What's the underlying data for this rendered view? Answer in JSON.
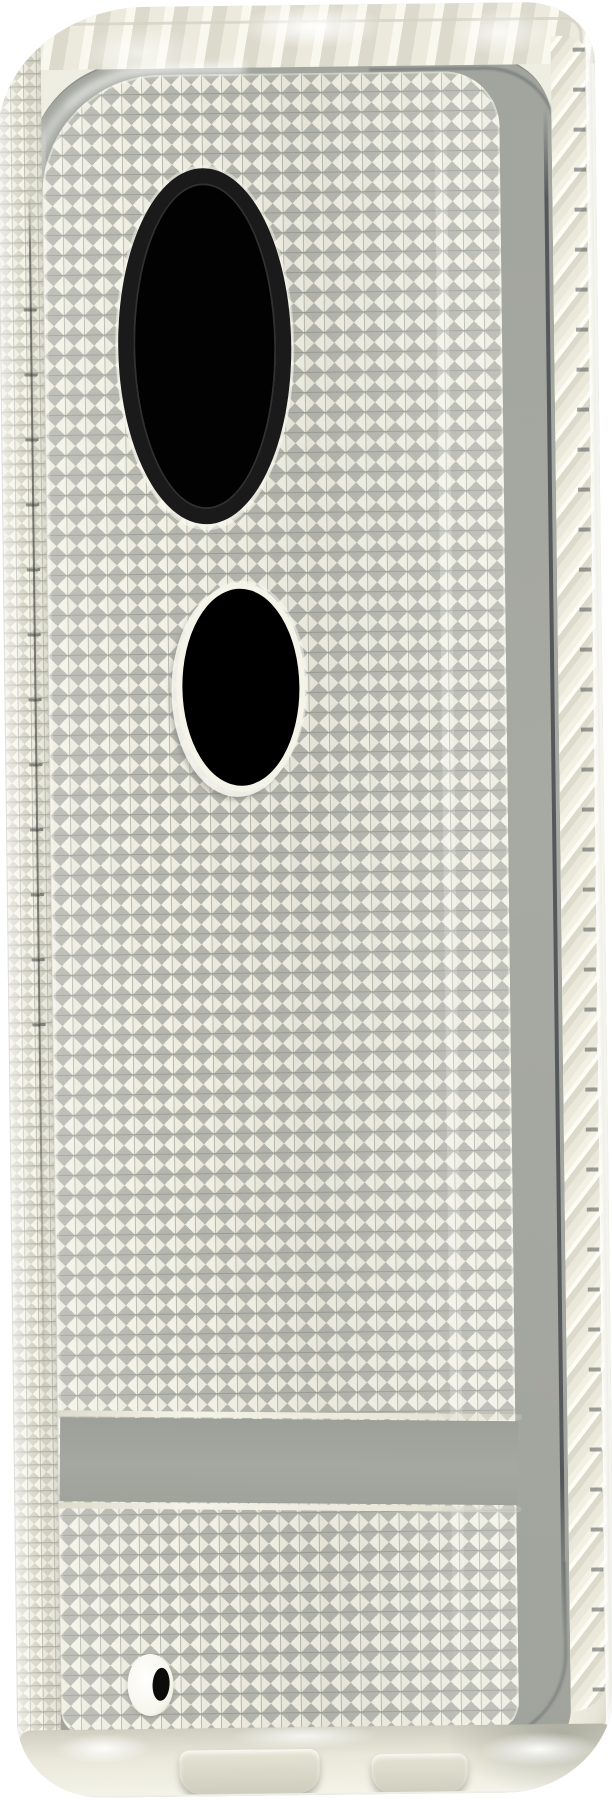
{
  "scene": {
    "type": "product-photo",
    "subject": "clear transparent phone case with diamond-stud texture",
    "view": "rear three-quarter angle",
    "visible_text": ""
  },
  "case": {
    "material": "clear flexible shell",
    "back_texture": "grid of small square diamond studs",
    "side_texture": "chevron facet rail on right edge",
    "cutouts": [
      {
        "name": "camera-cutout",
        "shape": "tall oval",
        "ring_color": "#1a1a1a",
        "hole_color": "#020202"
      },
      {
        "name": "fingerprint-cutout",
        "shape": "oval",
        "rim_color": "#f5f4e9",
        "hole_color": "#000000"
      },
      {
        "name": "mic-hole",
        "shape": "small oval",
        "ring_color": "#f7f6ec",
        "hole_color": "#0c0c0a"
      }
    ],
    "brand_band": {
      "present": true,
      "finish": "smooth untextured strip near bottom"
    },
    "bottom_edge": {
      "port_bumps": 2,
      "finish": "clear with glare highlights"
    }
  },
  "colors": {
    "background": "#ffffff",
    "case-face": "#efeee2",
    "case-edge": "#e2e1d2",
    "rim-ivory": "#eceadd",
    "phone-gray": "#a7aaa2",
    "band-gray": "#a5a8a0",
    "stud-base": "#9da098",
    "stud-light": "#f3f2e6",
    "stud-facet": "#b4b6ad",
    "phone-edge-dark": "#55585a",
    "chevron-fleck": "rgba(79,84,82,.55)",
    "camera-ring": "#1a1a1a",
    "camera-hole": "#020202",
    "fingerprint-hole": "#000000",
    "cutout-rim": "#f5f4e9",
    "mic-ring": "#f7f6ec",
    "mic-hole": "#0c0c0a"
  },
  "geometry": {
    "stage-width": "612px",
    "stage-height": "1800px",
    "camera-center": "(205, 340)",
    "camera-size": "173 x 356",
    "fingerprint-center": "(243, 687)",
    "fingerprint-size": "129 x 209",
    "band-y": "1420-1505",
    "mic-hole-center": "(140, 1682)",
    "stud-pitch": "20px"
  }
}
